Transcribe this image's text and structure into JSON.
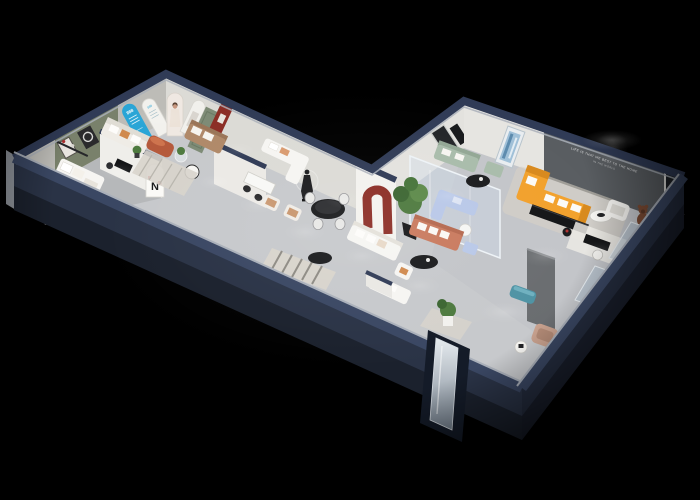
{
  "scene": {
    "alt": "Isometric 3D cutaway render of a furniture showroom floor plan on a black background",
    "slogan_line1": "LIFE IS THAT WE BEST TO THE HOME",
    "slogan_line2": "IN THE WORLD",
    "pillar_logo": "N",
    "blue_arch_text": "888",
    "white_arch_text": "888"
  },
  "colors": {
    "background": "#000000",
    "wall_cap": "#303b56",
    "wall_face": "#2a3346",
    "wall_face_east": "#242c3e",
    "wall_highlight": "#aab0ba",
    "floor": "#c7c9cc",
    "inner_wall": "#dcdbd6",
    "olive_wall": "#79816b",
    "feature_wall": "#595d61",
    "arch_blue": "#2aa5d6",
    "arch_red": "#8c2e26",
    "door_sage": "#7e8b76",
    "sofa_orange": "#f2a12c",
    "sofa_coral": "#c97a5e",
    "sofa_sage": "#a9bcab",
    "sofa_periwinkle": "#b9c8e8",
    "bench_teal": "#4f93a4",
    "ottoman_terracotta": "#b55a3c",
    "sofa_cream": "#efece6",
    "furn_dark": "#141517",
    "glass": "#cfdeed",
    "rug": "#d8d4cc",
    "plant_green": "#4e7a3f",
    "bear_brown": "#7a4a33"
  }
}
